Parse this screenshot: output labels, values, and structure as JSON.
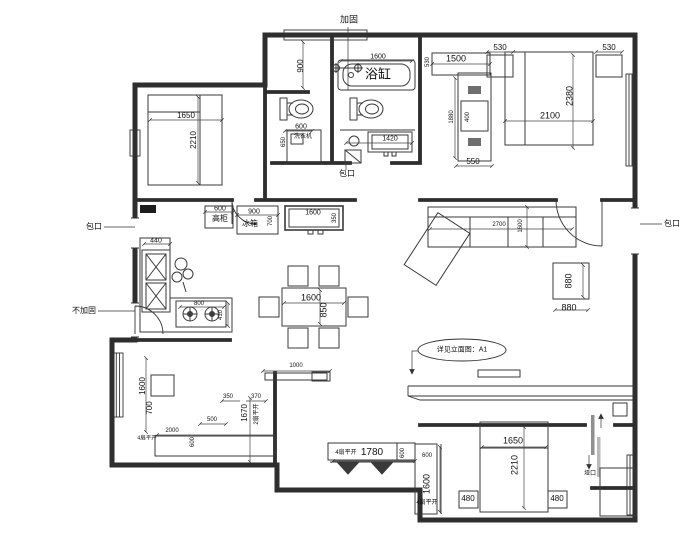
{
  "colors": {
    "line": "#2e2e2e",
    "dim_text": "#111",
    "hatch": "#777",
    "sliding_door": "#999"
  },
  "labels": [
    {
      "name": "note-reinforce",
      "text": "加固",
      "x": 349,
      "y": 20,
      "size": 9
    },
    {
      "name": "dim-corridor-900",
      "text": "900",
      "x": 301,
      "y": 66,
      "rot": -90
    },
    {
      "name": "dim-bathtub-1600",
      "text": "1600",
      "x": 378,
      "y": 57,
      "size": 7
    },
    {
      "name": "bathtub-label",
      "text": "浴缸",
      "x": 378,
      "y": 74,
      "size": 13
    },
    {
      "name": "dim-washer-600",
      "text": "600",
      "x": 301,
      "y": 127,
      "size": 7
    },
    {
      "name": "washer-label",
      "text": "洗衣机",
      "x": 303,
      "y": 137,
      "size": 6
    },
    {
      "name": "dim-washer-650",
      "text": "650",
      "x": 284,
      "y": 142,
      "rot": -90,
      "size": 6
    },
    {
      "name": "dim-vanity-1420",
      "text": "1420",
      "x": 390,
      "y": 139,
      "size": 7
    },
    {
      "name": "note-baokou-mid",
      "text": "包口",
      "x": 347,
      "y": 174,
      "size": 8
    },
    {
      "name": "dim-bed-tl-1650",
      "text": "1650",
      "x": 186,
      "y": 116
    },
    {
      "name": "dim-bed-tl-2210",
      "text": "2210",
      "x": 194,
      "y": 140,
      "rot": -90
    },
    {
      "name": "dim-closet-530v",
      "text": "530",
      "x": 428,
      "y": 62,
      "rot": -90,
      "size": 6
    },
    {
      "name": "dim-closet-1500",
      "text": "1500",
      "x": 456,
      "y": 59,
      "size": 9
    },
    {
      "name": "dim-nightstand-530l",
      "text": "530",
      "x": 500,
      "y": 48
    },
    {
      "name": "dim-nightstand-530r",
      "text": "530",
      "x": 609,
      "y": 48
    },
    {
      "name": "dim-bed-tr-2100",
      "text": "2100",
      "x": 550,
      "y": 116,
      "size": 9
    },
    {
      "name": "dim-bed-tr-2380",
      "text": "2380",
      "x": 570,
      "y": 96,
      "rot": -90,
      "size": 9
    },
    {
      "name": "dim-wardrobe-1880",
      "text": "1880",
      "x": 452,
      "y": 117,
      "rot": -90,
      "size": 6
    },
    {
      "name": "dim-wardrobe-400",
      "text": "400",
      "x": 468,
      "y": 117,
      "rot": -90,
      "size": 6
    },
    {
      "name": "dim-wardrobe-550",
      "text": "550",
      "x": 473,
      "y": 162
    },
    {
      "name": "dim-cabinet-600",
      "text": "600",
      "x": 220,
      "y": 209,
      "size": 7
    },
    {
      "name": "tall-cabinet-label",
      "text": "高柜",
      "x": 220,
      "y": 219,
      "size": 8
    },
    {
      "name": "dim-fridge-900",
      "text": "900",
      "x": 254,
      "y": 212,
      "size": 7
    },
    {
      "name": "fridge-label",
      "text": "冰箱",
      "x": 250,
      "y": 224,
      "size": 8
    },
    {
      "name": "dim-fridge-700",
      "text": "700",
      "x": 271,
      "y": 221,
      "rot": -90,
      "size": 6
    },
    {
      "name": "dim-entry-cab-1600",
      "text": "1600",
      "x": 313,
      "y": 213,
      "size": 7
    },
    {
      "name": "dim-entry-cab-350",
      "text": "350",
      "x": 335,
      "y": 218,
      "rot": -90,
      "size": 6
    },
    {
      "name": "dim-sink-440",
      "text": "440",
      "x": 156,
      "y": 241,
      "size": 7
    },
    {
      "name": "dim-stove-800",
      "text": "800",
      "x": 199,
      "y": 304,
      "size": 6
    },
    {
      "name": "dim-stove-410",
      "text": "410",
      "x": 221,
      "y": 315,
      "rot": -90,
      "size": 6
    },
    {
      "name": "note-baokou-left",
      "text": "包口",
      "x": 94,
      "y": 227,
      "size": 8
    },
    {
      "name": "note-no-reinforce",
      "text": "不加固",
      "x": 84,
      "y": 311,
      "size": 8
    },
    {
      "name": "dim-table-1600",
      "text": "1600",
      "x": 311,
      "y": 298,
      "size": 9
    },
    {
      "name": "dim-table-850",
      "text": "850",
      "x": 324,
      "y": 310,
      "rot": -90,
      "size": 9
    },
    {
      "name": "dim-sofa-2700",
      "text": "2700",
      "x": 499,
      "y": 225,
      "size": 6
    },
    {
      "name": "dim-sofa-1600",
      "text": "1600",
      "x": 521,
      "y": 226,
      "rot": -90,
      "size": 6
    },
    {
      "name": "dim-coffee-880v",
      "text": "880",
      "x": 569,
      "y": 281,
      "rot": -90,
      "size": 9
    },
    {
      "name": "dim-coffee-880h",
      "text": "880",
      "x": 569,
      "y": 308,
      "size": 9
    },
    {
      "name": "note-elevation",
      "text": "详见立面图：A1",
      "x": 462,
      "y": 350,
      "size": 7
    },
    {
      "name": "note-baokou-right",
      "text": "包口",
      "x": 672,
      "y": 224,
      "size": 8
    },
    {
      "name": "dim-shelf-1000",
      "text": "1000",
      "x": 296,
      "y": 366,
      "size": 6
    },
    {
      "name": "dim-desk-1600",
      "text": "1600",
      "x": 143,
      "y": 386,
      "rot": -90
    },
    {
      "name": "dim-desk-700",
      "text": "700",
      "x": 150,
      "y": 408,
      "rot": -90
    },
    {
      "name": "dim-bl-350",
      "text": "350",
      "x": 228,
      "y": 397,
      "size": 6
    },
    {
      "name": "dim-bl-370",
      "text": "370",
      "x": 256,
      "y": 397,
      "size": 6
    },
    {
      "name": "dim-bl-1670",
      "text": "1670",
      "x": 245,
      "y": 413,
      "rot": -90,
      "size": 8
    },
    {
      "name": "door-2leaf-label",
      "text": "2扇平开",
      "x": 257,
      "y": 414,
      "rot": -90,
      "size": 6
    },
    {
      "name": "dim-bl-500",
      "text": "500",
      "x": 212,
      "y": 420,
      "size": 6
    },
    {
      "name": "door-4leaf-bl-label",
      "text": "4扇平开",
      "x": 147,
      "y": 439,
      "size": 5.5
    },
    {
      "name": "dim-wardrobe-bl-2000",
      "text": "2000",
      "x": 172,
      "y": 431,
      "size": 6
    },
    {
      "name": "dim-wardrobe-bl-600",
      "text": "600",
      "x": 193,
      "y": 442,
      "rot": -90,
      "size": 6
    },
    {
      "name": "door-4leaf-mid-label",
      "text": "4扇平开",
      "x": 346,
      "y": 453,
      "size": 6
    },
    {
      "name": "dim-mid-closet-1780",
      "text": "1780",
      "x": 372,
      "y": 453,
      "size": 10
    },
    {
      "name": "dim-mid-closet-600",
      "text": "600",
      "x": 403,
      "y": 453,
      "rot": -90,
      "size": 6
    },
    {
      "name": "dim-br-strip-600",
      "text": "600",
      "x": 427,
      "y": 456,
      "size": 6
    },
    {
      "name": "dim-br-strip-1600",
      "text": "1600",
      "x": 427,
      "y": 484,
      "rot": -90,
      "size": 9
    },
    {
      "name": "door-4leaf-br-label",
      "text": "4扇平开",
      "x": 427,
      "y": 503,
      "size": 6
    },
    {
      "name": "dim-bed-br-1650",
      "text": "1650",
      "x": 513,
      "y": 441,
      "size": 9
    },
    {
      "name": "dim-bed-br-2210",
      "text": "2210",
      "x": 515,
      "y": 465,
      "rot": -90,
      "size": 9
    },
    {
      "name": "dim-nightstand-480l",
      "text": "480",
      "x": 468,
      "y": 499
    },
    {
      "name": "dim-nightstand-480r",
      "text": "480",
      "x": 557,
      "y": 499
    },
    {
      "name": "note-yakou",
      "text": "垭口",
      "x": 590,
      "y": 474,
      "size": 6
    }
  ]
}
